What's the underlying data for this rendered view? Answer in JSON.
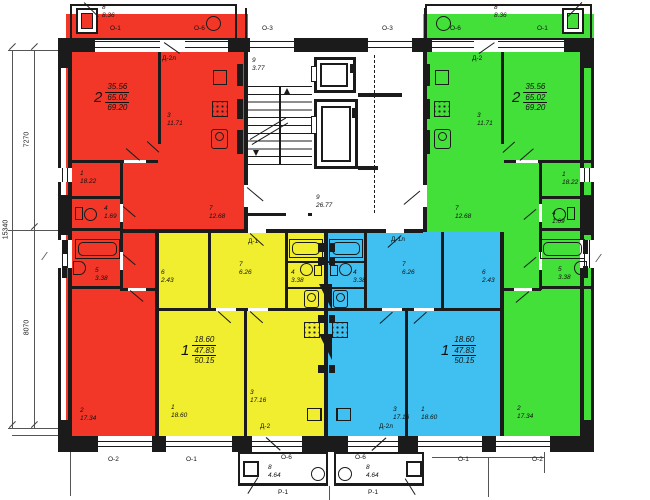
{
  "colors": {
    "red": "#f23728",
    "green": "#43e03a",
    "yellow": "#f1ee2f",
    "blue": "#3fc0f0"
  },
  "dimensions": {
    "upper": "7270",
    "lower": "8070",
    "total": "15340"
  },
  "codes": {
    "o1": "О-1",
    "o2": "О-2",
    "o3": "О-3",
    "o6": "О-6",
    "d1": "Д-1",
    "d1l": "Д-1л",
    "d2": "Д-2",
    "d2l": "Д-2л",
    "p1": "Р-1"
  },
  "common": {
    "stair": {
      "num": "9",
      "area": "3.77"
    },
    "hall": {
      "num": "9",
      "area": "26.77"
    }
  },
  "apartments": {
    "red": {
      "rooms_count": "2",
      "living_area": "35.56",
      "total_area": "65.02",
      "total_with_balcony": "69.20",
      "rooms": {
        "r1": {
          "num": "1",
          "area": "18.22"
        },
        "r3": {
          "num": "3",
          "area": "11.71"
        },
        "r4": {
          "num": "4",
          "area": "1.69"
        },
        "r5": {
          "num": "5",
          "area": "3.38"
        },
        "r7": {
          "num": "7",
          "area": "12.68"
        },
        "r2": {
          "num": "2",
          "area": "17.34"
        },
        "balcony": {
          "num": "8",
          "area": "8.36"
        }
      }
    },
    "green": {
      "rooms_count": "2",
      "living_area": "35.56",
      "total_area": "65.02",
      "total_with_balcony": "69.20",
      "rooms": {
        "r1": {
          "num": "1",
          "area": "18.22"
        },
        "r3": {
          "num": "3",
          "area": "11.71"
        },
        "r4": {
          "num": "4",
          "area": "1.69"
        },
        "r5": {
          "num": "5",
          "area": "3.38"
        },
        "r7": {
          "num": "7",
          "area": "12.68"
        },
        "r2": {
          "num": "2",
          "area": "17.34"
        },
        "balcony": {
          "num": "8",
          "area": "8.36"
        }
      }
    },
    "yellow": {
      "rooms_count": "1",
      "living_area": "18.60",
      "total_area": "47.83",
      "total_with_balcony": "50.15",
      "rooms": {
        "r1": {
          "num": "1",
          "area": "18.60"
        },
        "r3": {
          "num": "3",
          "area": "17.16"
        },
        "r4": {
          "num": "4",
          "area": "3.38"
        },
        "r6": {
          "num": "6",
          "area": "2.43"
        },
        "r7": {
          "num": "7",
          "area": "6.26"
        },
        "balcony": {
          "num": "8",
          "area": "4.64"
        }
      }
    },
    "blue": {
      "rooms_count": "1",
      "living_area": "18.60",
      "total_area": "47.83",
      "total_with_balcony": "50.15",
      "rooms": {
        "r1": {
          "num": "1",
          "area": "18.60"
        },
        "r3": {
          "num": "3",
          "area": "17.16"
        },
        "r4": {
          "num": "4",
          "area": "3.38"
        },
        "r6": {
          "num": "6",
          "area": "2.43"
        },
        "r7": {
          "num": "7",
          "area": "6.26"
        },
        "balcony": {
          "num": "8",
          "area": "4.64"
        }
      }
    }
  }
}
